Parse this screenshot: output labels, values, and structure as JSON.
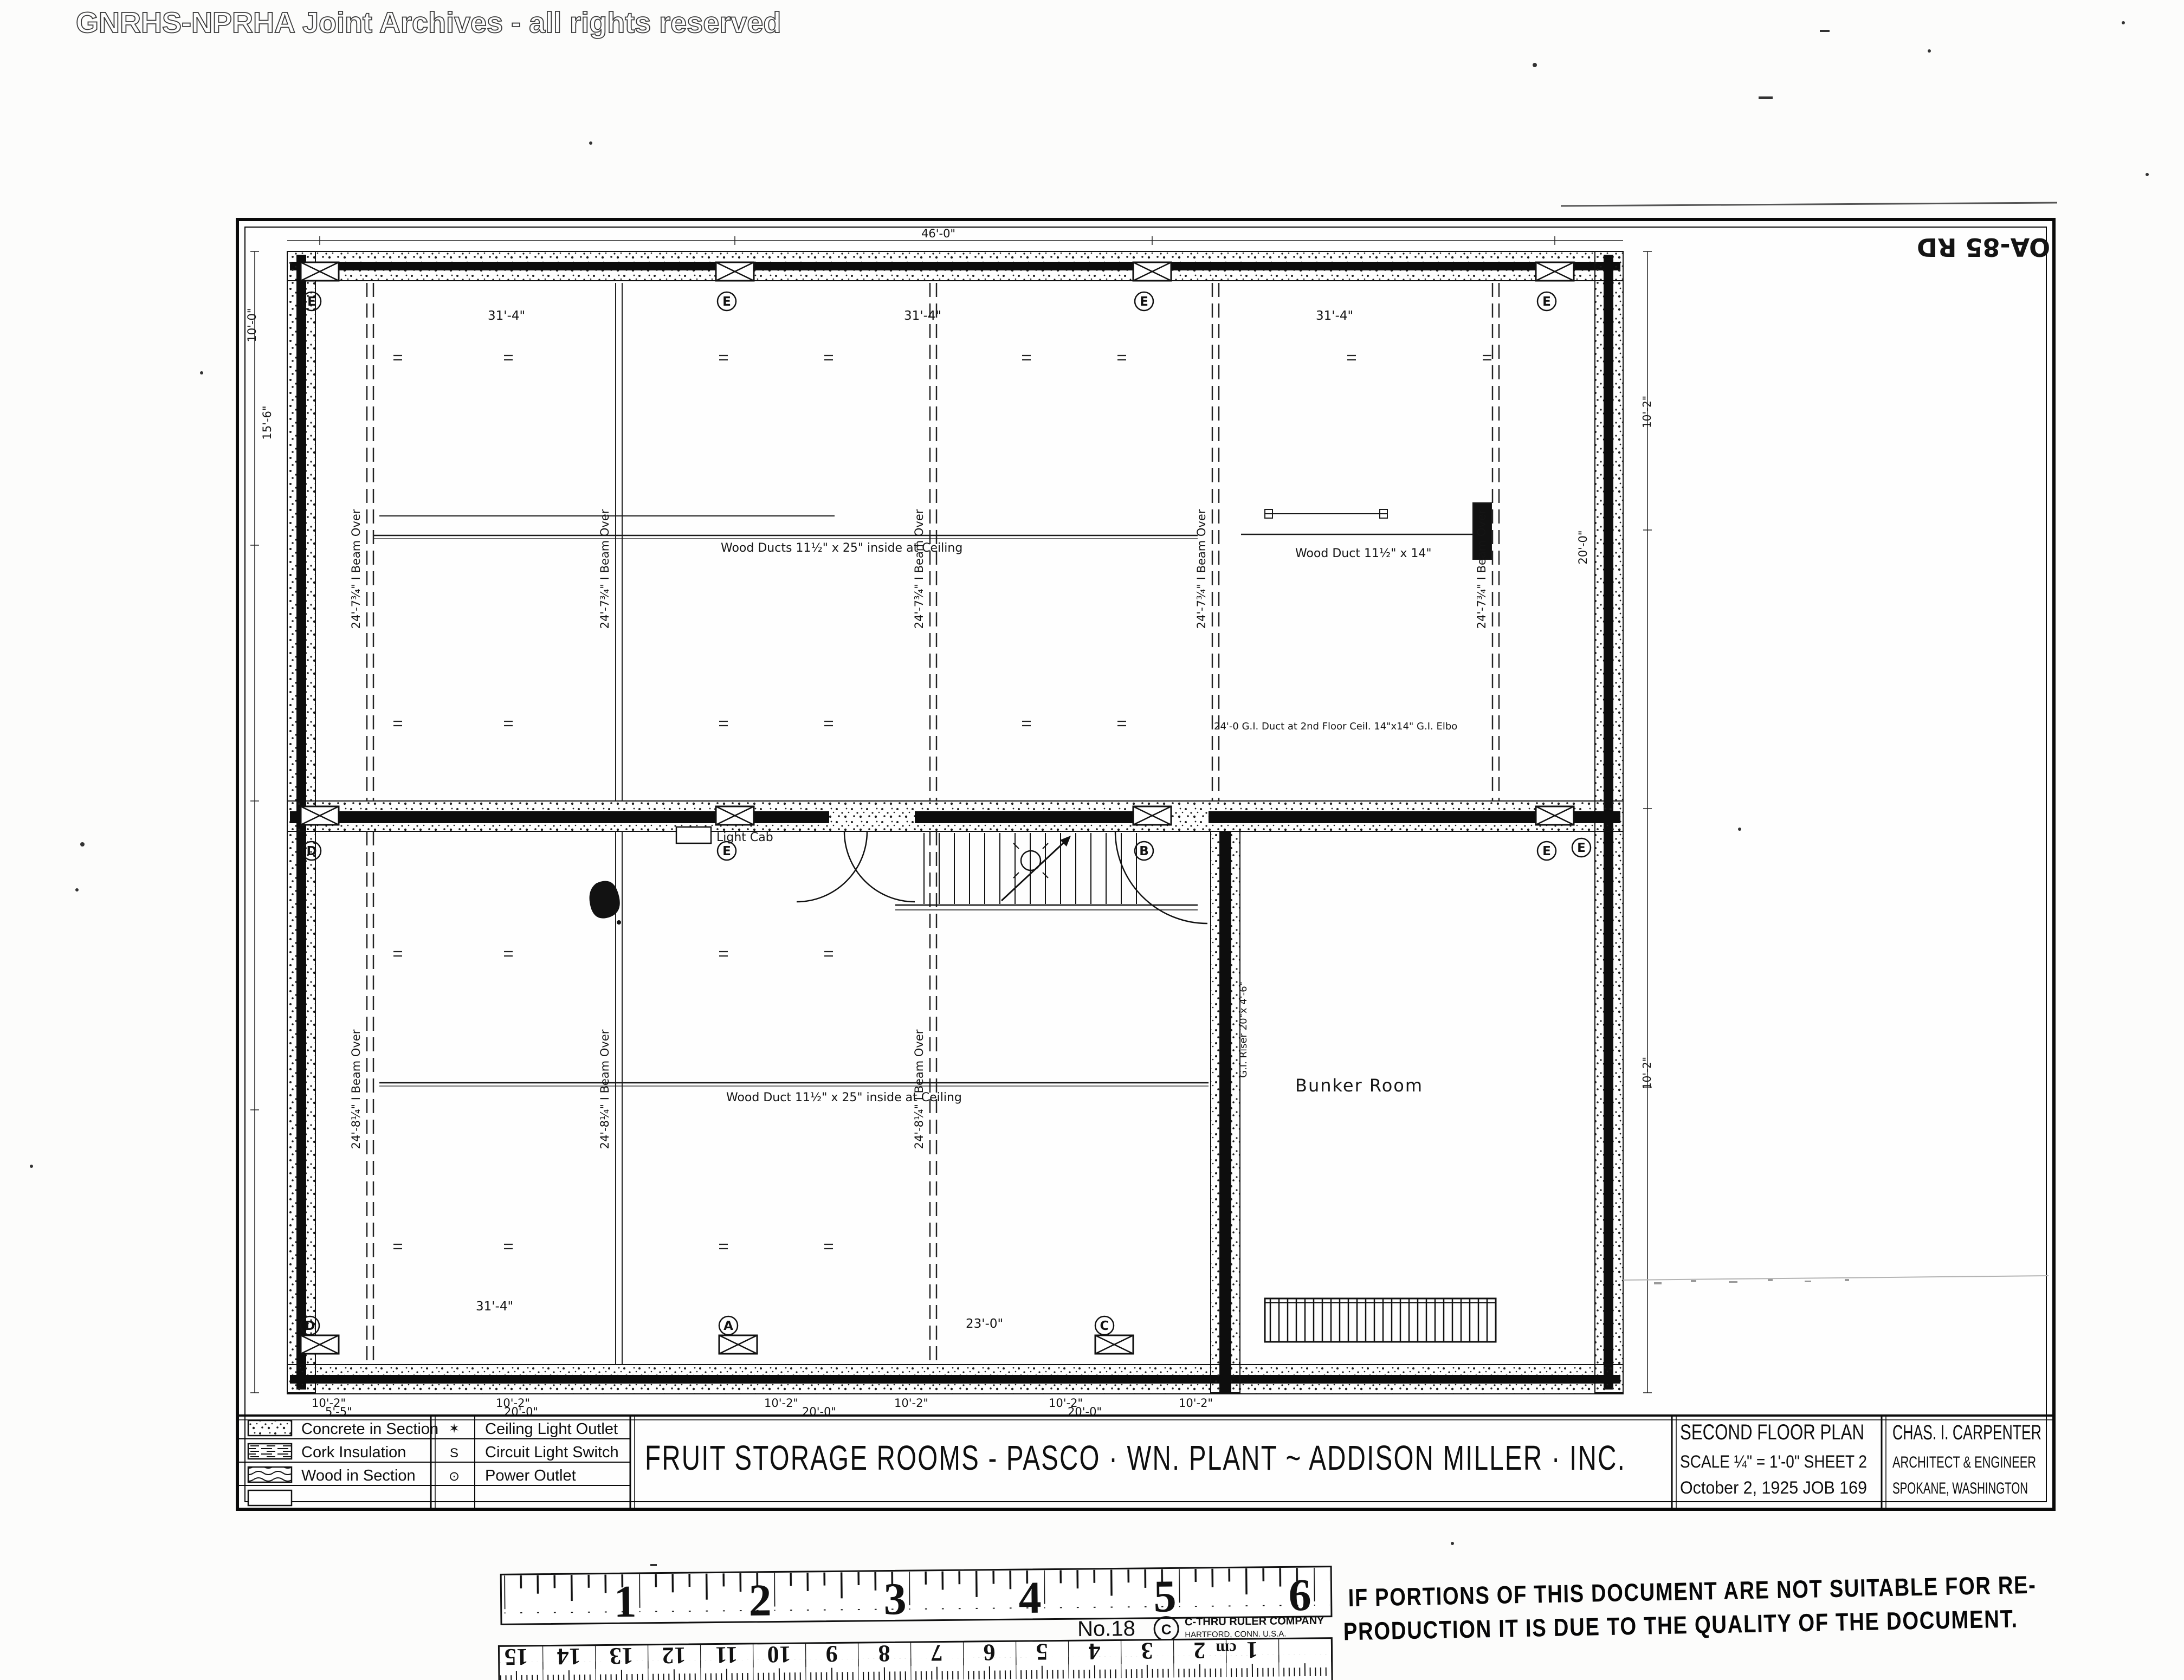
{
  "watermark": "GNRHS-NPRHA Joint Archives - all rights reserved",
  "archive_mark": "OA-85 RD",
  "title_block": {
    "title": "FRUIT STORAGE ROOMS - PASCO · WN. PLANT ~ ADDISON MILLER · INC.",
    "materials_legend": [
      {
        "swatch": "concrete-stipple-swatch",
        "label": "Concrete in Section"
      },
      {
        "swatch": "cork-dashes-swatch",
        "label": "Cork Insulation"
      },
      {
        "swatch": "wood-waves-swatch",
        "label": "Wood in Section"
      }
    ],
    "symbols_legend": [
      {
        "symbol": "✶",
        "label": "Ceiling Light Outlet"
      },
      {
        "symbol": "S",
        "label": "Circuit Light Switch"
      },
      {
        "symbol": "⊙",
        "label": "Power Outlet"
      }
    ],
    "drawing_info": {
      "line1": "SECOND FLOOR PLAN",
      "line2": "SCALE ¼\" = 1'-0\"   SHEET 2",
      "line3": "October 2, 1925  JOB 169"
    },
    "architect": {
      "line1": "CHAS. I. CARPENTER",
      "line2": "ARCHITECT & ENGINEER",
      "line3": "SPOKANE, WASHINGTON"
    }
  },
  "plan": {
    "room_labels": {
      "bunker": "Bunker Room",
      "light_cab": "Light Cab"
    },
    "duct_labels": {
      "top": "Wood Ducts 11½\" x 25\" inside at Ceiling",
      "right": "Wood Duct 11½\" x 14\"",
      "bottom": "Wood Duct 11½\" x 25\" inside at Ceiling"
    },
    "beam_label_top": "24'-7¾\" I Beam Over",
    "beam_label_bottom": "24'-8¼\" I Beam Over",
    "notes": {
      "duct_note": "24'-0 G.I. Duct at 2nd Floor Ceil. 14\"x14\" G.I. Elbo",
      "riser": "G.I. Riser 20\"x 4'-6\""
    },
    "column_marks": {
      "top": [
        "E",
        "E",
        "E",
        "E"
      ],
      "middle": [
        "D",
        "E",
        "B",
        "E"
      ],
      "bottom": [
        "D",
        "A",
        "C"
      ],
      "right": "E"
    },
    "dimensions": {
      "bay": "31'-4\"",
      "d10_2": "10'-2\"",
      "d20_0": "20'-0\"",
      "d5_5": "5'-5\"",
      "d23_0": "23'-0\"",
      "d10_0": "10'-0\"",
      "d15_6": "15'-6\"",
      "d46_0": "46'-0\"",
      "right_20": "20'-0\""
    }
  },
  "ruler": {
    "inches": [
      "1",
      "2",
      "3",
      "4",
      "5",
      "6"
    ],
    "model": "No.18",
    "brand": "C-THRU RULER COMPANY",
    "brand_sub": "HARTFORD, CONN. U.S.A.",
    "cm_numbers": [
      "15",
      "14",
      "13",
      "12",
      "11",
      "10",
      "9",
      "8",
      "7",
      "6",
      "5",
      "4",
      "3",
      "2",
      "1"
    ],
    "cm_label": "cm"
  },
  "stamp": {
    "line1": "IF PORTIONS OF THIS DOCUMENT ARE NOT SUITABLE FOR RE-",
    "line2": "PRODUCTION IT IS DUE TO THE QUALITY OF THE DOCUMENT."
  }
}
